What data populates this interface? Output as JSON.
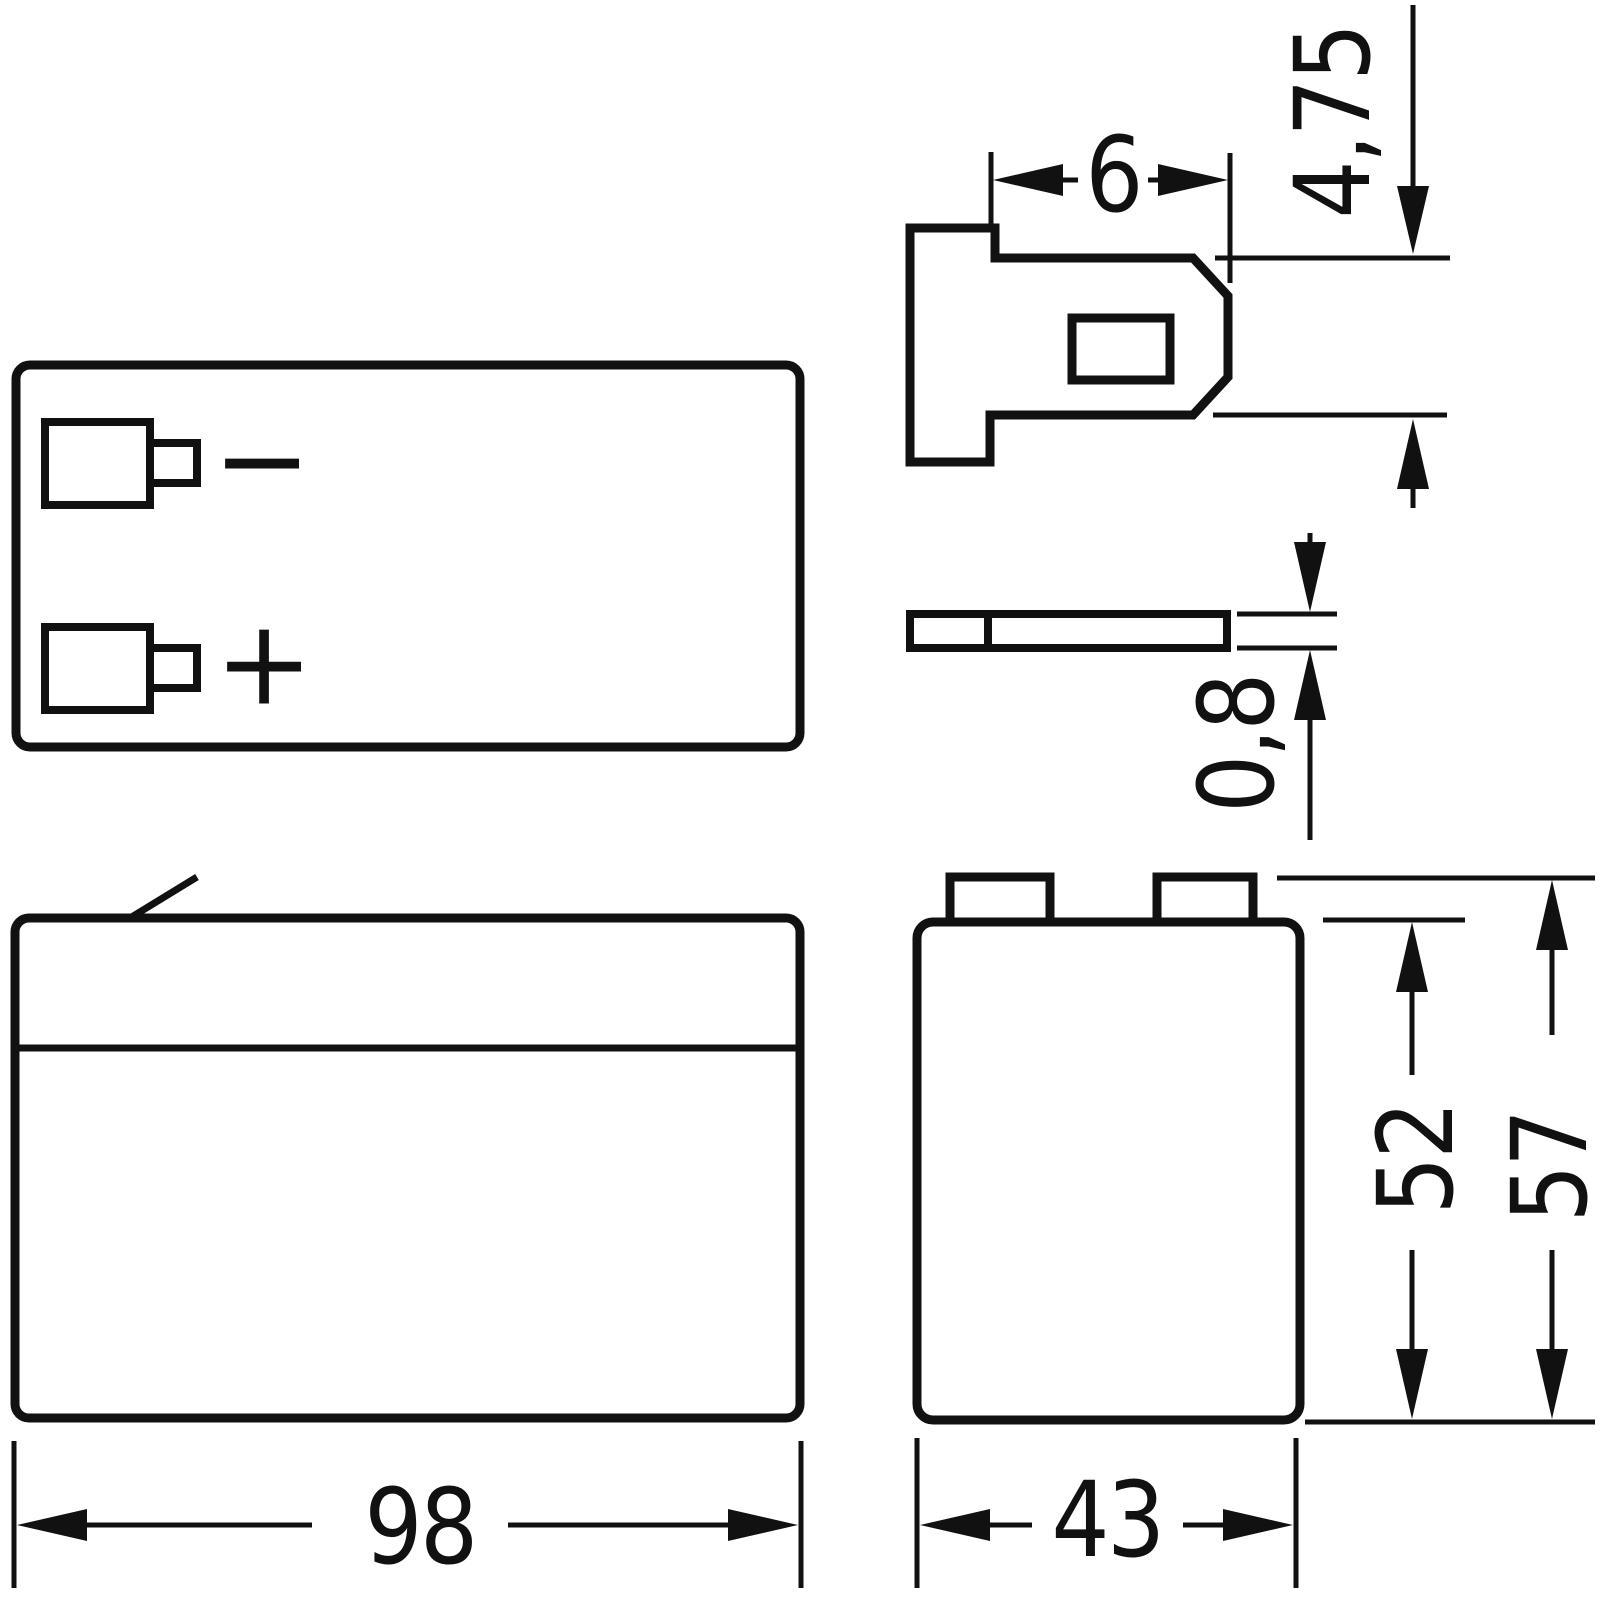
{
  "drawing_title": "battery-outline-dimension-drawing",
  "colors": {
    "ink": "#111111",
    "paper": "#ffffff"
  },
  "polarity": {
    "negative": "−",
    "positive": "+"
  },
  "dimensions": {
    "terminal_tab_width": "6",
    "terminal_tab_height": "4,75",
    "terminal_tab_thickness": "0,8",
    "battery_length": "98",
    "battery_width": "43",
    "case_height": "52",
    "overall_height": "57"
  }
}
